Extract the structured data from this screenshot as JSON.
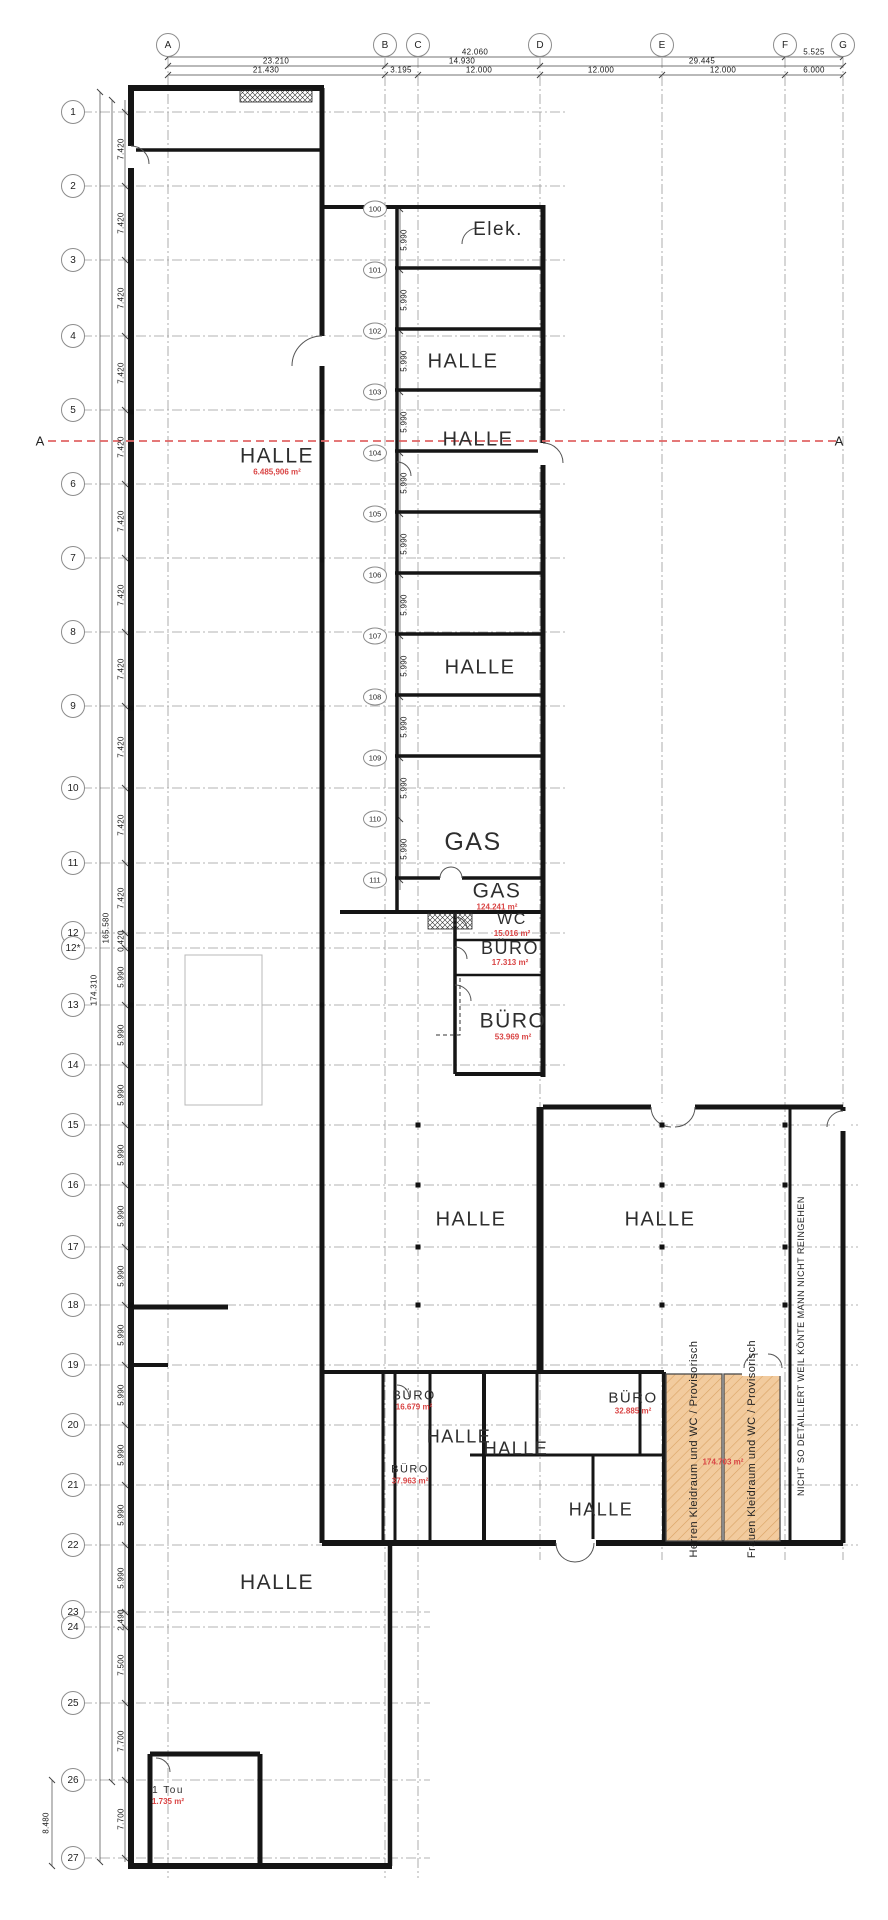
{
  "colors": {
    "area_label": "#d94444",
    "section_line": "#e06666",
    "orange_room": "#f2cb9e",
    "grid_line": "#9a9a9a",
    "wall": "#151515"
  },
  "top_grid": {
    "letters": [
      {
        "label": "A",
        "x": 168,
        "y": 45
      },
      {
        "label": "B",
        "x": 385,
        "y": 45
      },
      {
        "label": "C",
        "x": 418,
        "y": 45
      },
      {
        "label": "D",
        "x": 540,
        "y": 45
      },
      {
        "label": "E",
        "x": 662,
        "y": 45
      },
      {
        "label": "F",
        "x": 785,
        "y": 45
      },
      {
        "label": "G",
        "x": 843,
        "y": 45
      }
    ]
  },
  "top_dims": [
    {
      "text": "42.060",
      "x": 475,
      "y": 52
    },
    {
      "text": "5.525",
      "x": 814,
      "y": 52
    },
    {
      "text": "23.210",
      "x": 276,
      "y": 61
    },
    {
      "text": "14.930",
      "x": 462,
      "y": 61
    },
    {
      "text": "29.445",
      "x": 702,
      "y": 61
    },
    {
      "text": "21.430",
      "x": 266,
      "y": 70
    },
    {
      "text": "3.195",
      "x": 401,
      "y": 70
    },
    {
      "text": "12.000",
      "x": 479,
      "y": 70
    },
    {
      "text": "12.000",
      "x": 601,
      "y": 70
    },
    {
      "text": "12.000",
      "x": 723,
      "y": 70
    },
    {
      "text": "6.000",
      "x": 814,
      "y": 70
    }
  ],
  "left_grid": {
    "numbers": [
      {
        "label": "1",
        "x": 73,
        "y": 112
      },
      {
        "label": "2",
        "x": 73,
        "y": 186
      },
      {
        "label": "3",
        "x": 73,
        "y": 260
      },
      {
        "label": "4",
        "x": 73,
        "y": 336
      },
      {
        "label": "5",
        "x": 73,
        "y": 410
      },
      {
        "label": "6",
        "x": 73,
        "y": 484
      },
      {
        "label": "7",
        "x": 73,
        "y": 558
      },
      {
        "label": "8",
        "x": 73,
        "y": 632
      },
      {
        "label": "9",
        "x": 73,
        "y": 706
      },
      {
        "label": "10",
        "x": 73,
        "y": 788
      },
      {
        "label": "11",
        "x": 73,
        "y": 863
      },
      {
        "label": "12",
        "x": 73,
        "y": 933
      },
      {
        "label": "12*",
        "x": 73,
        "y": 948
      },
      {
        "label": "13",
        "x": 73,
        "y": 1005
      },
      {
        "label": "14",
        "x": 73,
        "y": 1065
      },
      {
        "label": "15",
        "x": 73,
        "y": 1125
      },
      {
        "label": "16",
        "x": 73,
        "y": 1185
      },
      {
        "label": "17",
        "x": 73,
        "y": 1247
      },
      {
        "label": "18",
        "x": 73,
        "y": 1305
      },
      {
        "label": "19",
        "x": 73,
        "y": 1365
      },
      {
        "label": "20",
        "x": 73,
        "y": 1425
      },
      {
        "label": "21",
        "x": 73,
        "y": 1485
      },
      {
        "label": "22",
        "x": 73,
        "y": 1545
      },
      {
        "label": "23",
        "x": 73,
        "y": 1612
      },
      {
        "label": "24",
        "x": 73,
        "y": 1627
      },
      {
        "label": "25",
        "x": 73,
        "y": 1703
      },
      {
        "label": "26",
        "x": 73,
        "y": 1780
      },
      {
        "label": "27",
        "x": 73,
        "y": 1858
      }
    ]
  },
  "left_dims": [
    {
      "text": "7.420",
      "x": 121,
      "y": 149
    },
    {
      "text": "7.420",
      "x": 121,
      "y": 223
    },
    {
      "text": "7.420",
      "x": 121,
      "y": 298
    },
    {
      "text": "7.420",
      "x": 121,
      "y": 373
    },
    {
      "text": "7.420",
      "x": 121,
      "y": 447
    },
    {
      "text": "7.420",
      "x": 121,
      "y": 521
    },
    {
      "text": "7.420",
      "x": 121,
      "y": 595
    },
    {
      "text": "7.420",
      "x": 121,
      "y": 669
    },
    {
      "text": "7.420",
      "x": 121,
      "y": 747
    },
    {
      "text": "7.420",
      "x": 121,
      "y": 825
    },
    {
      "text": "7.420",
      "x": 121,
      "y": 898
    },
    {
      "text": "0.420",
      "x": 121,
      "y": 941
    },
    {
      "text": "5.990",
      "x": 121,
      "y": 977
    },
    {
      "text": "5.990",
      "x": 121,
      "y": 1035
    },
    {
      "text": "5.990",
      "x": 121,
      "y": 1095
    },
    {
      "text": "5.990",
      "x": 121,
      "y": 1155
    },
    {
      "text": "5.990",
      "x": 121,
      "y": 1216
    },
    {
      "text": "5.990",
      "x": 121,
      "y": 1276
    },
    {
      "text": "5.990",
      "x": 121,
      "y": 1335
    },
    {
      "text": "5.990",
      "x": 121,
      "y": 1395
    },
    {
      "text": "5.990",
      "x": 121,
      "y": 1455
    },
    {
      "text": "5.990",
      "x": 121,
      "y": 1515
    },
    {
      "text": "5.990",
      "x": 121,
      "y": 1578
    },
    {
      "text": "2.490",
      "x": 121,
      "y": 1620
    },
    {
      "text": "7.500",
      "x": 121,
      "y": 1665
    },
    {
      "text": "7.700",
      "x": 121,
      "y": 1741
    },
    {
      "text": "7.700",
      "x": 121,
      "y": 1819
    }
  ],
  "chain_totals": [
    {
      "text": "165.580",
      "x": 106,
      "y": 928
    },
    {
      "text": "174.310",
      "x": 94,
      "y": 990
    },
    {
      "text": "8.480",
      "x": 46,
      "y": 1823
    }
  ],
  "room_circles": [
    {
      "label": "100",
      "x": 375,
      "y": 209
    },
    {
      "label": "101",
      "x": 375,
      "y": 270
    },
    {
      "label": "102",
      "x": 375,
      "y": 331
    },
    {
      "label": "103",
      "x": 375,
      "y": 392
    },
    {
      "label": "104",
      "x": 375,
      "y": 453
    },
    {
      "label": "105",
      "x": 375,
      "y": 514
    },
    {
      "label": "106",
      "x": 375,
      "y": 575
    },
    {
      "label": "107",
      "x": 375,
      "y": 636
    },
    {
      "label": "108",
      "x": 375,
      "y": 697
    },
    {
      "label": "109",
      "x": 375,
      "y": 758
    },
    {
      "label": "110",
      "x": 375,
      "y": 819
    },
    {
      "label": "111",
      "x": 375,
      "y": 880
    }
  ],
  "mid_dims": [
    {
      "text": "5.990",
      "x": 404,
      "y": 240
    },
    {
      "text": "5.990",
      "x": 404,
      "y": 300
    },
    {
      "text": "5.990",
      "x": 404,
      "y": 361
    },
    {
      "text": "5.990",
      "x": 404,
      "y": 422
    },
    {
      "text": "5.990",
      "x": 404,
      "y": 483
    },
    {
      "text": "5.990",
      "x": 404,
      "y": 544
    },
    {
      "text": "5.990",
      "x": 404,
      "y": 605
    },
    {
      "text": "5.990",
      "x": 404,
      "y": 666
    },
    {
      "text": "5.990",
      "x": 404,
      "y": 727
    },
    {
      "text": "5.990",
      "x": 404,
      "y": 788
    },
    {
      "text": "5.990",
      "x": 404,
      "y": 849
    }
  ],
  "rooms": [
    {
      "label": "Elek.",
      "x": 498,
      "y": 230,
      "fs": 19
    },
    {
      "label": "HALLE",
      "x": 463,
      "y": 362,
      "fs": 20
    },
    {
      "label": "HALLE",
      "area": "6.485,906 m²",
      "x": 277,
      "y": 461,
      "fs": 21
    },
    {
      "label": "HALLE",
      "x": 478,
      "y": 440,
      "fs": 20
    },
    {
      "label": "HALLE",
      "x": 480,
      "y": 668,
      "fs": 20
    },
    {
      "label": "GAS",
      "x": 473,
      "y": 842,
      "fs": 25
    },
    {
      "label": "GAS",
      "area": "124.241 m²",
      "x": 497,
      "y": 896,
      "fs": 21
    },
    {
      "label": "WC",
      "area": "15.016 m²",
      "x": 512,
      "y": 925,
      "fs": 16
    },
    {
      "label": "BÜRO",
      "area": "17.313 m²",
      "x": 510,
      "y": 953,
      "fs": 18
    },
    {
      "label": "BÜRO",
      "area": "53.969 m²",
      "x": 513,
      "y": 1026,
      "fs": 21
    },
    {
      "label": "HALLE",
      "x": 471,
      "y": 1220,
      "fs": 20
    },
    {
      "label": "HALLE",
      "x": 660,
      "y": 1220,
      "fs": 20
    },
    {
      "label": "BÜRO",
      "area": "16.679 m²",
      "x": 414,
      "y": 1400,
      "fs": 13
    },
    {
      "label": "BÜRO",
      "area": "32.885 m²",
      "x": 633,
      "y": 1403,
      "fs": 15
    },
    {
      "label": "HALLE",
      "x": 459,
      "y": 1437,
      "fs": 18
    },
    {
      "label": "HALLE",
      "x": 516,
      "y": 1449,
      "fs": 18
    },
    {
      "label": "BÜRO",
      "area": "37.963 m²",
      "x": 410,
      "y": 1475,
      "fs": 11
    },
    {
      "label": "HALLE",
      "x": 601,
      "y": 1510,
      "fs": 18
    },
    {
      "label": "HALLE",
      "x": 277,
      "y": 1583,
      "fs": 21
    },
    {
      "label": "1 Tou",
      "area": "1.735 m²",
      "x": 168,
      "y": 1796,
      "fs": 10
    },
    {
      "label": "",
      "area": "174.703 m²",
      "x": 723,
      "y": 1462,
      "fs": 10
    }
  ],
  "vertical_texts": [
    {
      "text": "Herren Kleidraum und WC / Provisorisch",
      "x": 694,
      "y": 1449,
      "fs": 11
    },
    {
      "text": "Frauen Kleidraum und WC / Provisorisch",
      "x": 752,
      "y": 1449,
      "fs": 11
    },
    {
      "text": "NICHT SO DETAILLIERT WEIL KÖNTE MANN NICHT REINGEHEN",
      "x": 801,
      "y": 1346,
      "fs": 9
    }
  ],
  "section_marks": [
    {
      "label": "A",
      "x": 40,
      "y": 441
    },
    {
      "label": "A",
      "x": 839,
      "y": 441
    }
  ]
}
